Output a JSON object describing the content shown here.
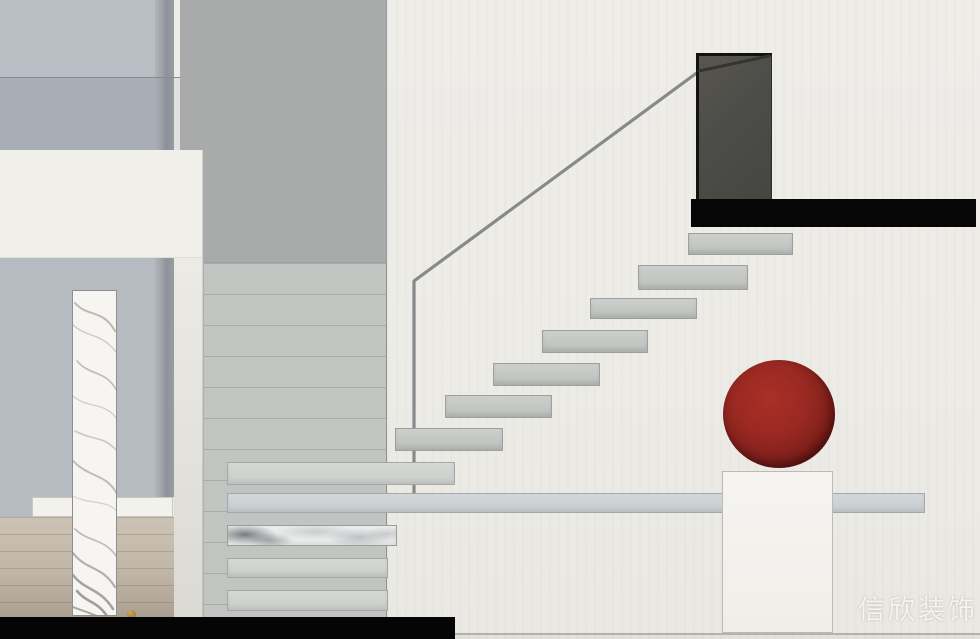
{
  "watermark": {
    "text": "信欣装饰"
  },
  "palette": {
    "blue-upper": "#b8bec4",
    "blue-mid": "#aeb4bb",
    "blue-lower": "#b6bbc1",
    "wall-gray": "#a9abaa",
    "panel-tiled": "#c2c4c1",
    "tile-line": "#a9aba8",
    "white-beam": "#f1efe9",
    "rail": "#88898b",
    "rail-dark": "#35342f",
    "door": "#4c4c48",
    "beam-black": "#060606",
    "tread-gray": "#c2c4c1",
    "slab-gray": "#ccd1d4",
    "sphere-red": "#8c2420",
    "pedestal-white": "#f4f2ed",
    "wood-tan": "#c0b6a8",
    "marble-white": "#f6f5f2"
  },
  "staircase": {
    "floating_treads": [
      {
        "name": "floating-tread",
        "x": 688,
        "y": 233,
        "w": 105,
        "h": 22
      },
      {
        "name": "floating-tread",
        "x": 638,
        "y": 265,
        "w": 110,
        "h": 25
      },
      {
        "name": "floating-tread",
        "x": 590,
        "y": 298,
        "w": 107,
        "h": 21
      },
      {
        "name": "floating-tread",
        "x": 542,
        "y": 330,
        "w": 106,
        "h": 23
      },
      {
        "name": "floating-tread",
        "x": 493,
        "y": 363,
        "w": 107,
        "h": 23
      },
      {
        "name": "floating-tread",
        "x": 445,
        "y": 395,
        "w": 107,
        "h": 23
      },
      {
        "name": "floating-tread",
        "x": 395,
        "y": 428,
        "w": 108,
        "h": 23
      }
    ],
    "lower_beams": [
      {
        "name": "stair-beam",
        "x": 227,
        "y": 462,
        "w": 228,
        "h": 23
      },
      {
        "name": "landing-slab",
        "x": 227,
        "y": 493,
        "w": 698,
        "h": 20,
        "variant": "slab"
      },
      {
        "name": "marble-beam",
        "x": 227,
        "y": 525,
        "w": 170,
        "h": 21,
        "variant": "marble"
      },
      {
        "name": "stair-beam",
        "x": 227,
        "y": 558,
        "w": 161,
        "h": 20
      },
      {
        "name": "stair-beam",
        "x": 227,
        "y": 590,
        "w": 161,
        "h": 21
      }
    ]
  }
}
